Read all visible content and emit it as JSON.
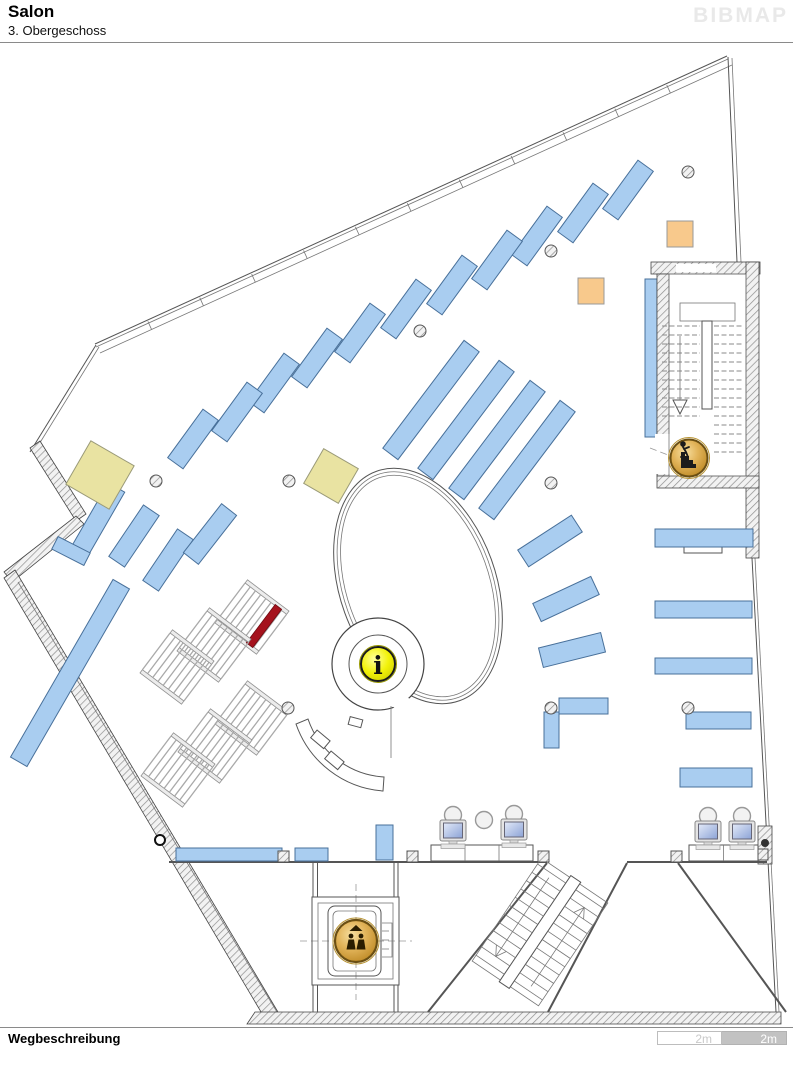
{
  "header": {
    "title": "Salon",
    "subtitle": "3. Obergeschoss",
    "logo": "BIBMAP"
  },
  "footer": {
    "heading": "Wegbeschreibung"
  },
  "scalebar": {
    "left_label": "2m",
    "right_label": "2m"
  },
  "map": {
    "floor": "3. Obergeschoss",
    "markers": {
      "info": {
        "name": "information-desk",
        "glyph": "i"
      },
      "elevator": {
        "name": "elevator-up"
      },
      "stairs": {
        "name": "stairs-down"
      }
    },
    "highlight": {
      "name": "destination-shelf",
      "color": "#A5121D"
    },
    "colors": {
      "shelf": "#A9CDF0",
      "shelf_border": "#48709A",
      "highlight": "#A5121D",
      "table_yellow": "#E9E3A2",
      "table_orange": "#F8C98C",
      "badge_yellow": "#F2F20A",
      "badge_gold": "#D9A843",
      "wall": "#555555",
      "screen": "#9FB2DE"
    }
  }
}
